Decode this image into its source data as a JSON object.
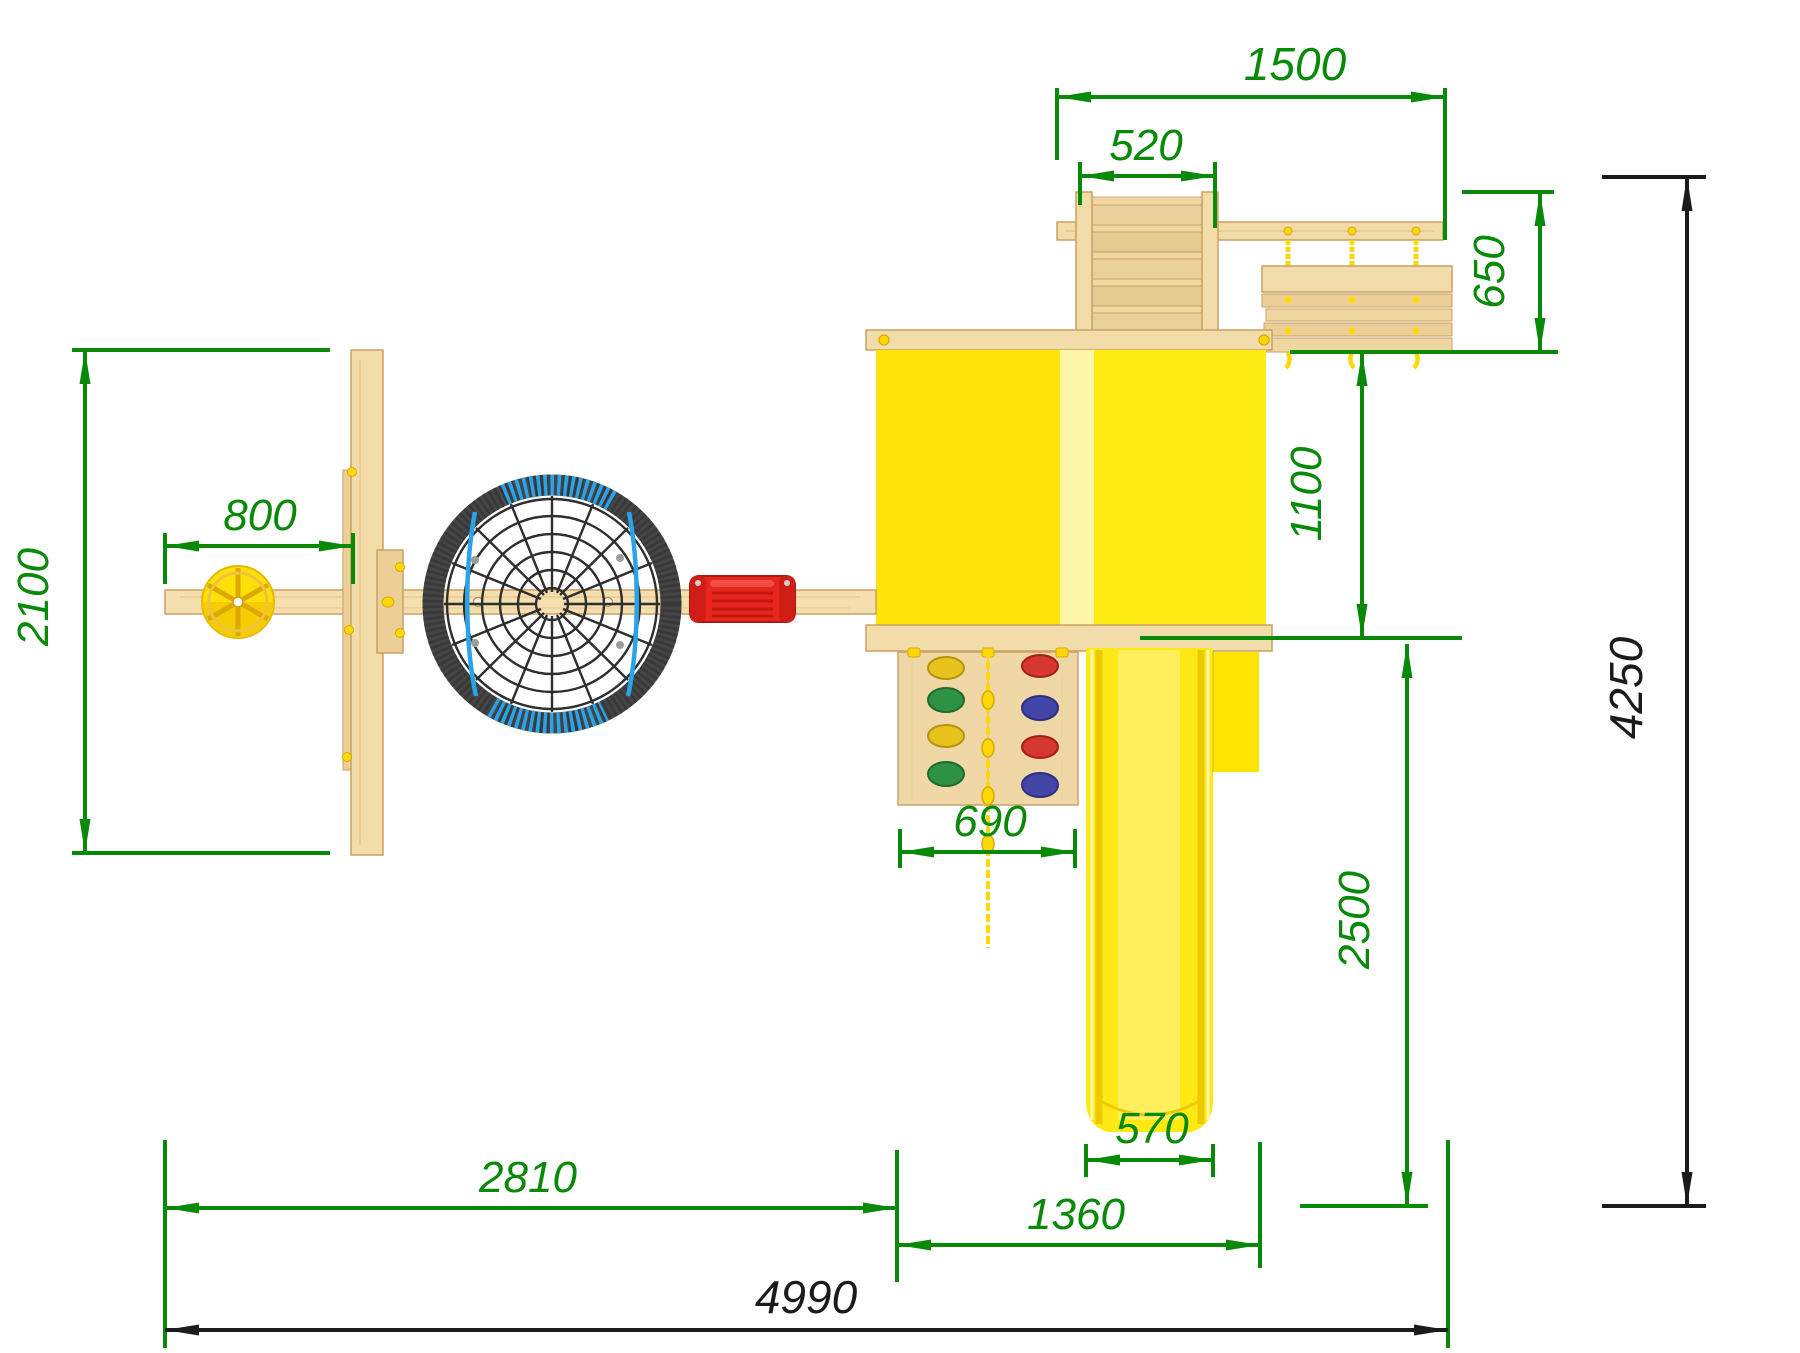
{
  "drawing": {
    "type": "playground-set plan view (top) with overall dimensions",
    "units": "mm",
    "colors": {
      "dimension_green": "#088a08",
      "dimension_black": "#1b1b1b",
      "wood": "#f2dcaa",
      "wood_edge": "#c8a263",
      "tower_yellow": "#ffe40a",
      "tower_stripe": "#fff7a8",
      "slide_yellow": "#ffe915",
      "swing_red": "#e8261e",
      "rope_yellow": "#ffd80a",
      "rope_blue": "#2ba3e8",
      "net_black": "#2e2e2e",
      "nest_rim": "#454545"
    },
    "dimensions": {
      "upper_frame_width": "1500",
      "ladder_width": "520",
      "rope_bridge_depth": "650",
      "bridge_to_tower": "1100",
      "aframe_depth": "2100",
      "beam_end_to_aframe": "800",
      "climbing_wall_width": "690",
      "slide_run_length": "2500",
      "slide_width": "570",
      "beam_span": "2810",
      "tower_footprint_width": "1360",
      "total_width": "4990",
      "total_depth": "4250"
    }
  }
}
